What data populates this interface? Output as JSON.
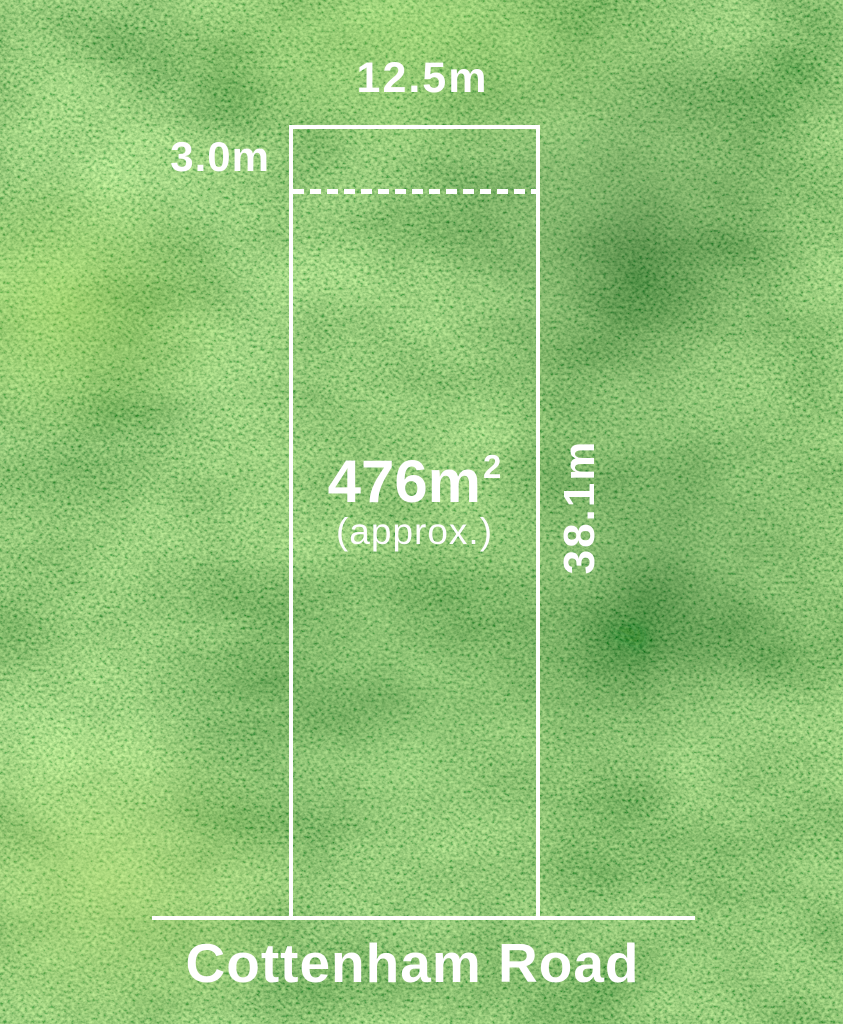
{
  "plan": {
    "frontage": "12.5m",
    "setback": "3.0m",
    "area_value": "476m",
    "area_exponent": "2",
    "area_approx": "(approx.)",
    "depth": "38.1m",
    "road_name": "Cottenham Road"
  },
  "colors": {
    "boundary_line": "#ffffff",
    "label_text": "#ffffff",
    "grass_mid": "#3f9c3c",
    "grass_dark": "#1e5c20",
    "grass_light": "#8cc63f"
  }
}
